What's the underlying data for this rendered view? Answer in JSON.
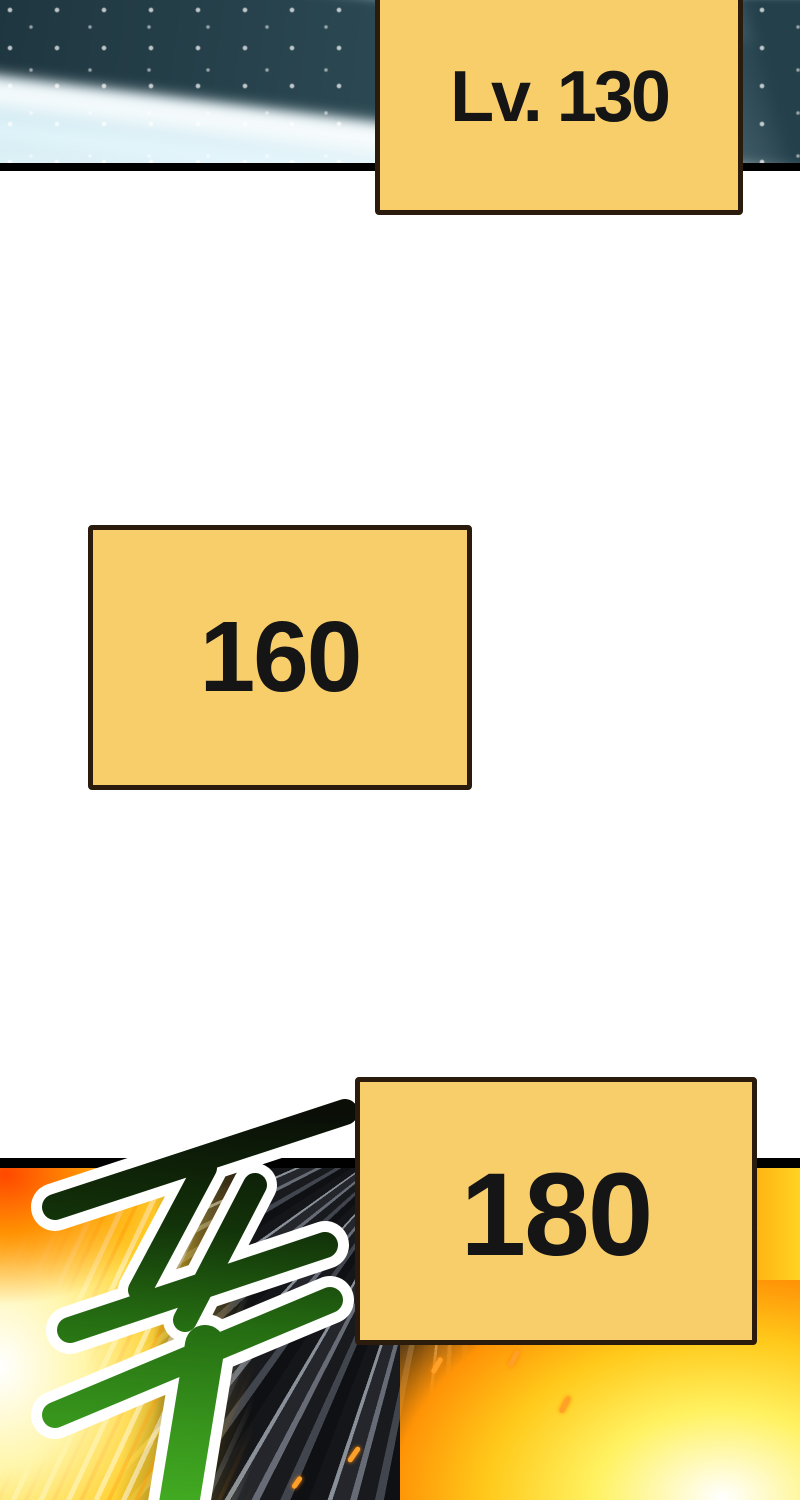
{
  "page": {
    "background": "#FFFFFF"
  },
  "panels": {
    "top": {
      "name": "ice-wave-panel",
      "description": "pale icy-blue energy wave with dark teal diagonal band and white glints"
    },
    "bottom": {
      "name": "explosion-panel",
      "description": "dark radiating speed lines with fiery explosion on left, right and bottom-right"
    }
  },
  "level_badges": [
    {
      "id": "badge-lv-130",
      "label": "Lv. 130"
    },
    {
      "id": "badge-160",
      "label": "160"
    },
    {
      "id": "badge-180",
      "label": "180"
    }
  ],
  "sfx": {
    "glyph": "푸",
    "style": "green brush-stroke Korean sound effect with white outline, dark at top fading to bright green"
  },
  "colors": {
    "badge_fill": "#F8CE6B",
    "badge_border": "#2B1B0D",
    "badge_text": "#151515",
    "panel_border": "#000000",
    "sfx_dark": "#0A0E07",
    "sfx_green": "#42AB22",
    "sfx_outline": "#FFFFFF"
  }
}
